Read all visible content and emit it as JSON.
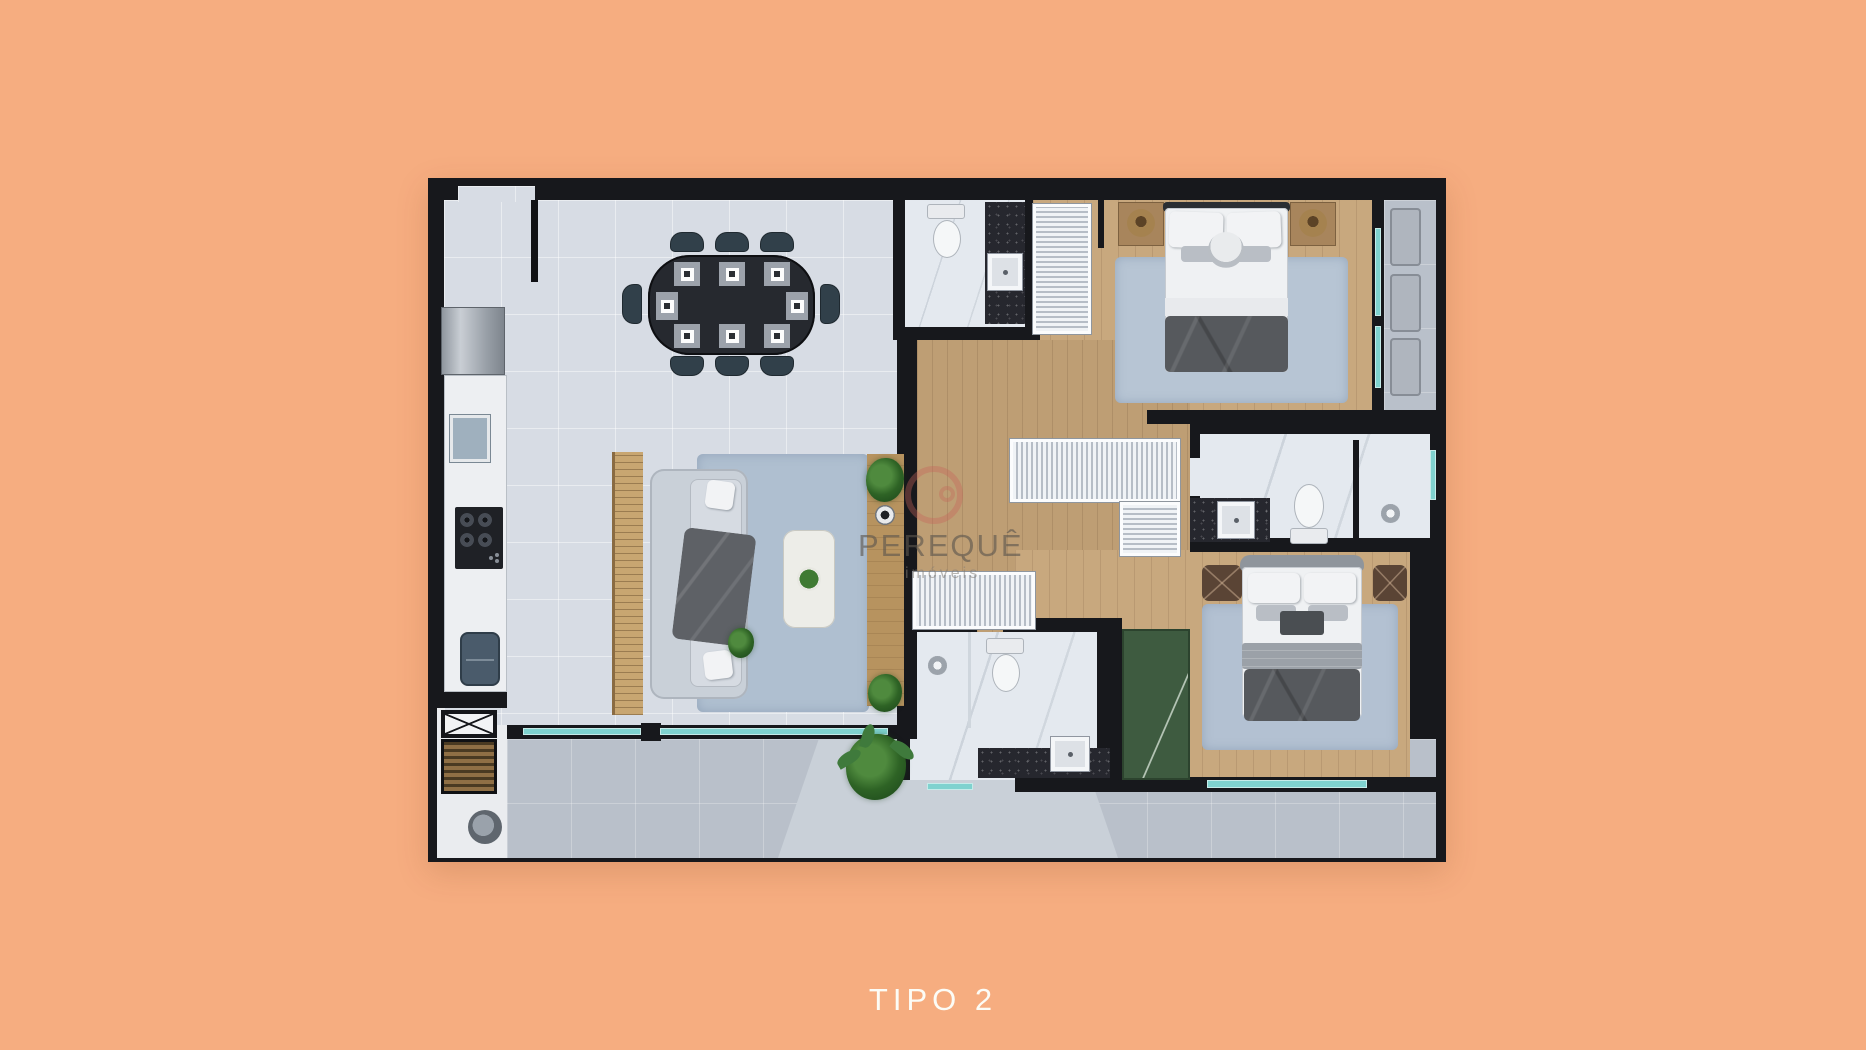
{
  "caption": {
    "label": "TIPO 2"
  },
  "watermark": {
    "brand": "PEREQUÊ",
    "tagline": "imóveis",
    "logo": "red-ring-logo",
    "logo_color": "#C6645A"
  },
  "palette": {
    "background": "#F6AD80",
    "wall": "#17181C",
    "tile": "#D7DCE4",
    "wood": "#C8A87E",
    "wood-dark": "#BE9E74",
    "balcony": "#B9C0CA",
    "balcony-light": "#C9D0D8",
    "marble": "#E4E9EF",
    "granite": "#26272E",
    "glass": "#7FD2CF",
    "rug": "#AFBFD0",
    "green": "#3E5B40",
    "white-furn": "#EFF1F3",
    "caption": "#FCFCF6"
  },
  "features": [
    "entry-door",
    "refrigerator",
    "kitchen-counter",
    "kitchen-sink",
    "cooktop",
    "double-basin-sink",
    "service-shaft",
    "barbecue-grill",
    "laundry-tub",
    "dining-table-8-seats",
    "place-settings",
    "wood-slat-panel",
    "sofa",
    "throw-blanket",
    "area-rug",
    "coffee-table",
    "plant-bowl",
    "tv-console",
    "monstera-plant",
    "speaker",
    "powder-room-toilet",
    "granite-vanity",
    "hanger-closet",
    "double-bed",
    "nightstand-lamp",
    "bedroom-rug",
    "glass-wall",
    "sun-loungers",
    "shower",
    "toilet",
    "wardrobe",
    "l-shaped-closet",
    "green-cabinet",
    "pouf",
    "palm-plant",
    "terrace",
    "sliding-glass-door",
    "window"
  ]
}
